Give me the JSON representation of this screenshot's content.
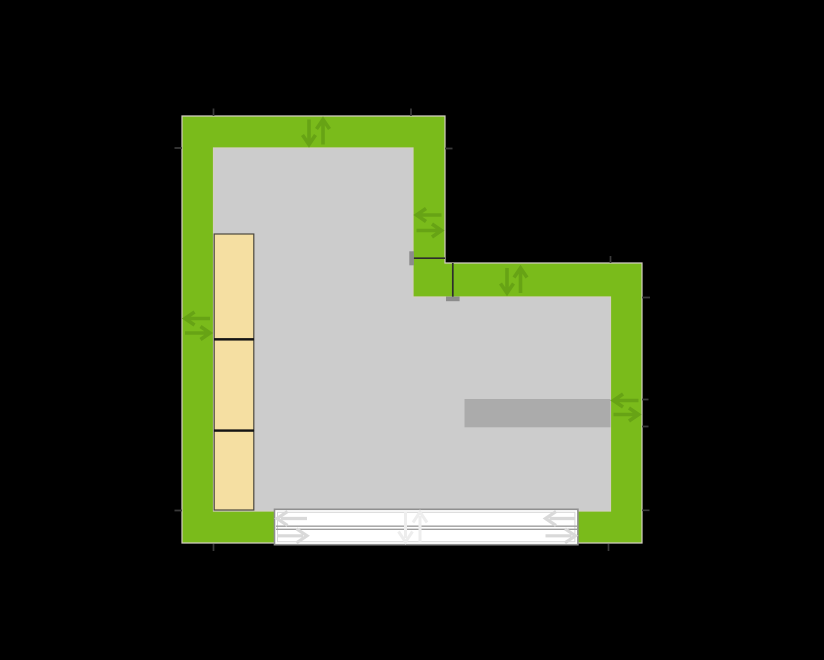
{
  "scene": {
    "type": "floor-plan",
    "room_shape": "L-shaped",
    "walls": [
      "top-wall",
      "left-wall",
      "inner-vertical-wall",
      "inner-horizontal-wall",
      "right-wall",
      "bottom-wall"
    ],
    "furniture": {
      "wall_cabinets_count": 3,
      "sideboard_count": 1
    },
    "door": {
      "type": "sliding-door",
      "panels": 2
    }
  },
  "colors": {
    "background": "#000000",
    "wall_fill": "#7abb1b",
    "wall_outline": "#d4cec2",
    "wall_handle_arrow": "#67a315",
    "floor_fill": "#cccccc",
    "cabinet_fill": "#f5dfa2",
    "cabinet_border": "#4a473d",
    "cabinet_divider": "#141414",
    "sideboard_fill": "#ababab",
    "door_fill": "#ffffff",
    "door_frame": "#8f8f8f",
    "door_inner_frame": "#d6d6d6",
    "door_rail": "#9e9e9e",
    "door_arrow": "#d9d9d9",
    "door_center_arrow": "#ededed",
    "joint_line": "#2d2d2d",
    "joint_cap": "#8c8c8c",
    "corner_tick": "#3a3a3a"
  },
  "icons": {
    "move-wall-vertical-icon": "↓↑",
    "move-wall-horizontal-icon": "⇆",
    "slide-door-left-icon": "←",
    "slide-door-right-icon": "→",
    "move-door-vertical-icon": "↓↑"
  }
}
